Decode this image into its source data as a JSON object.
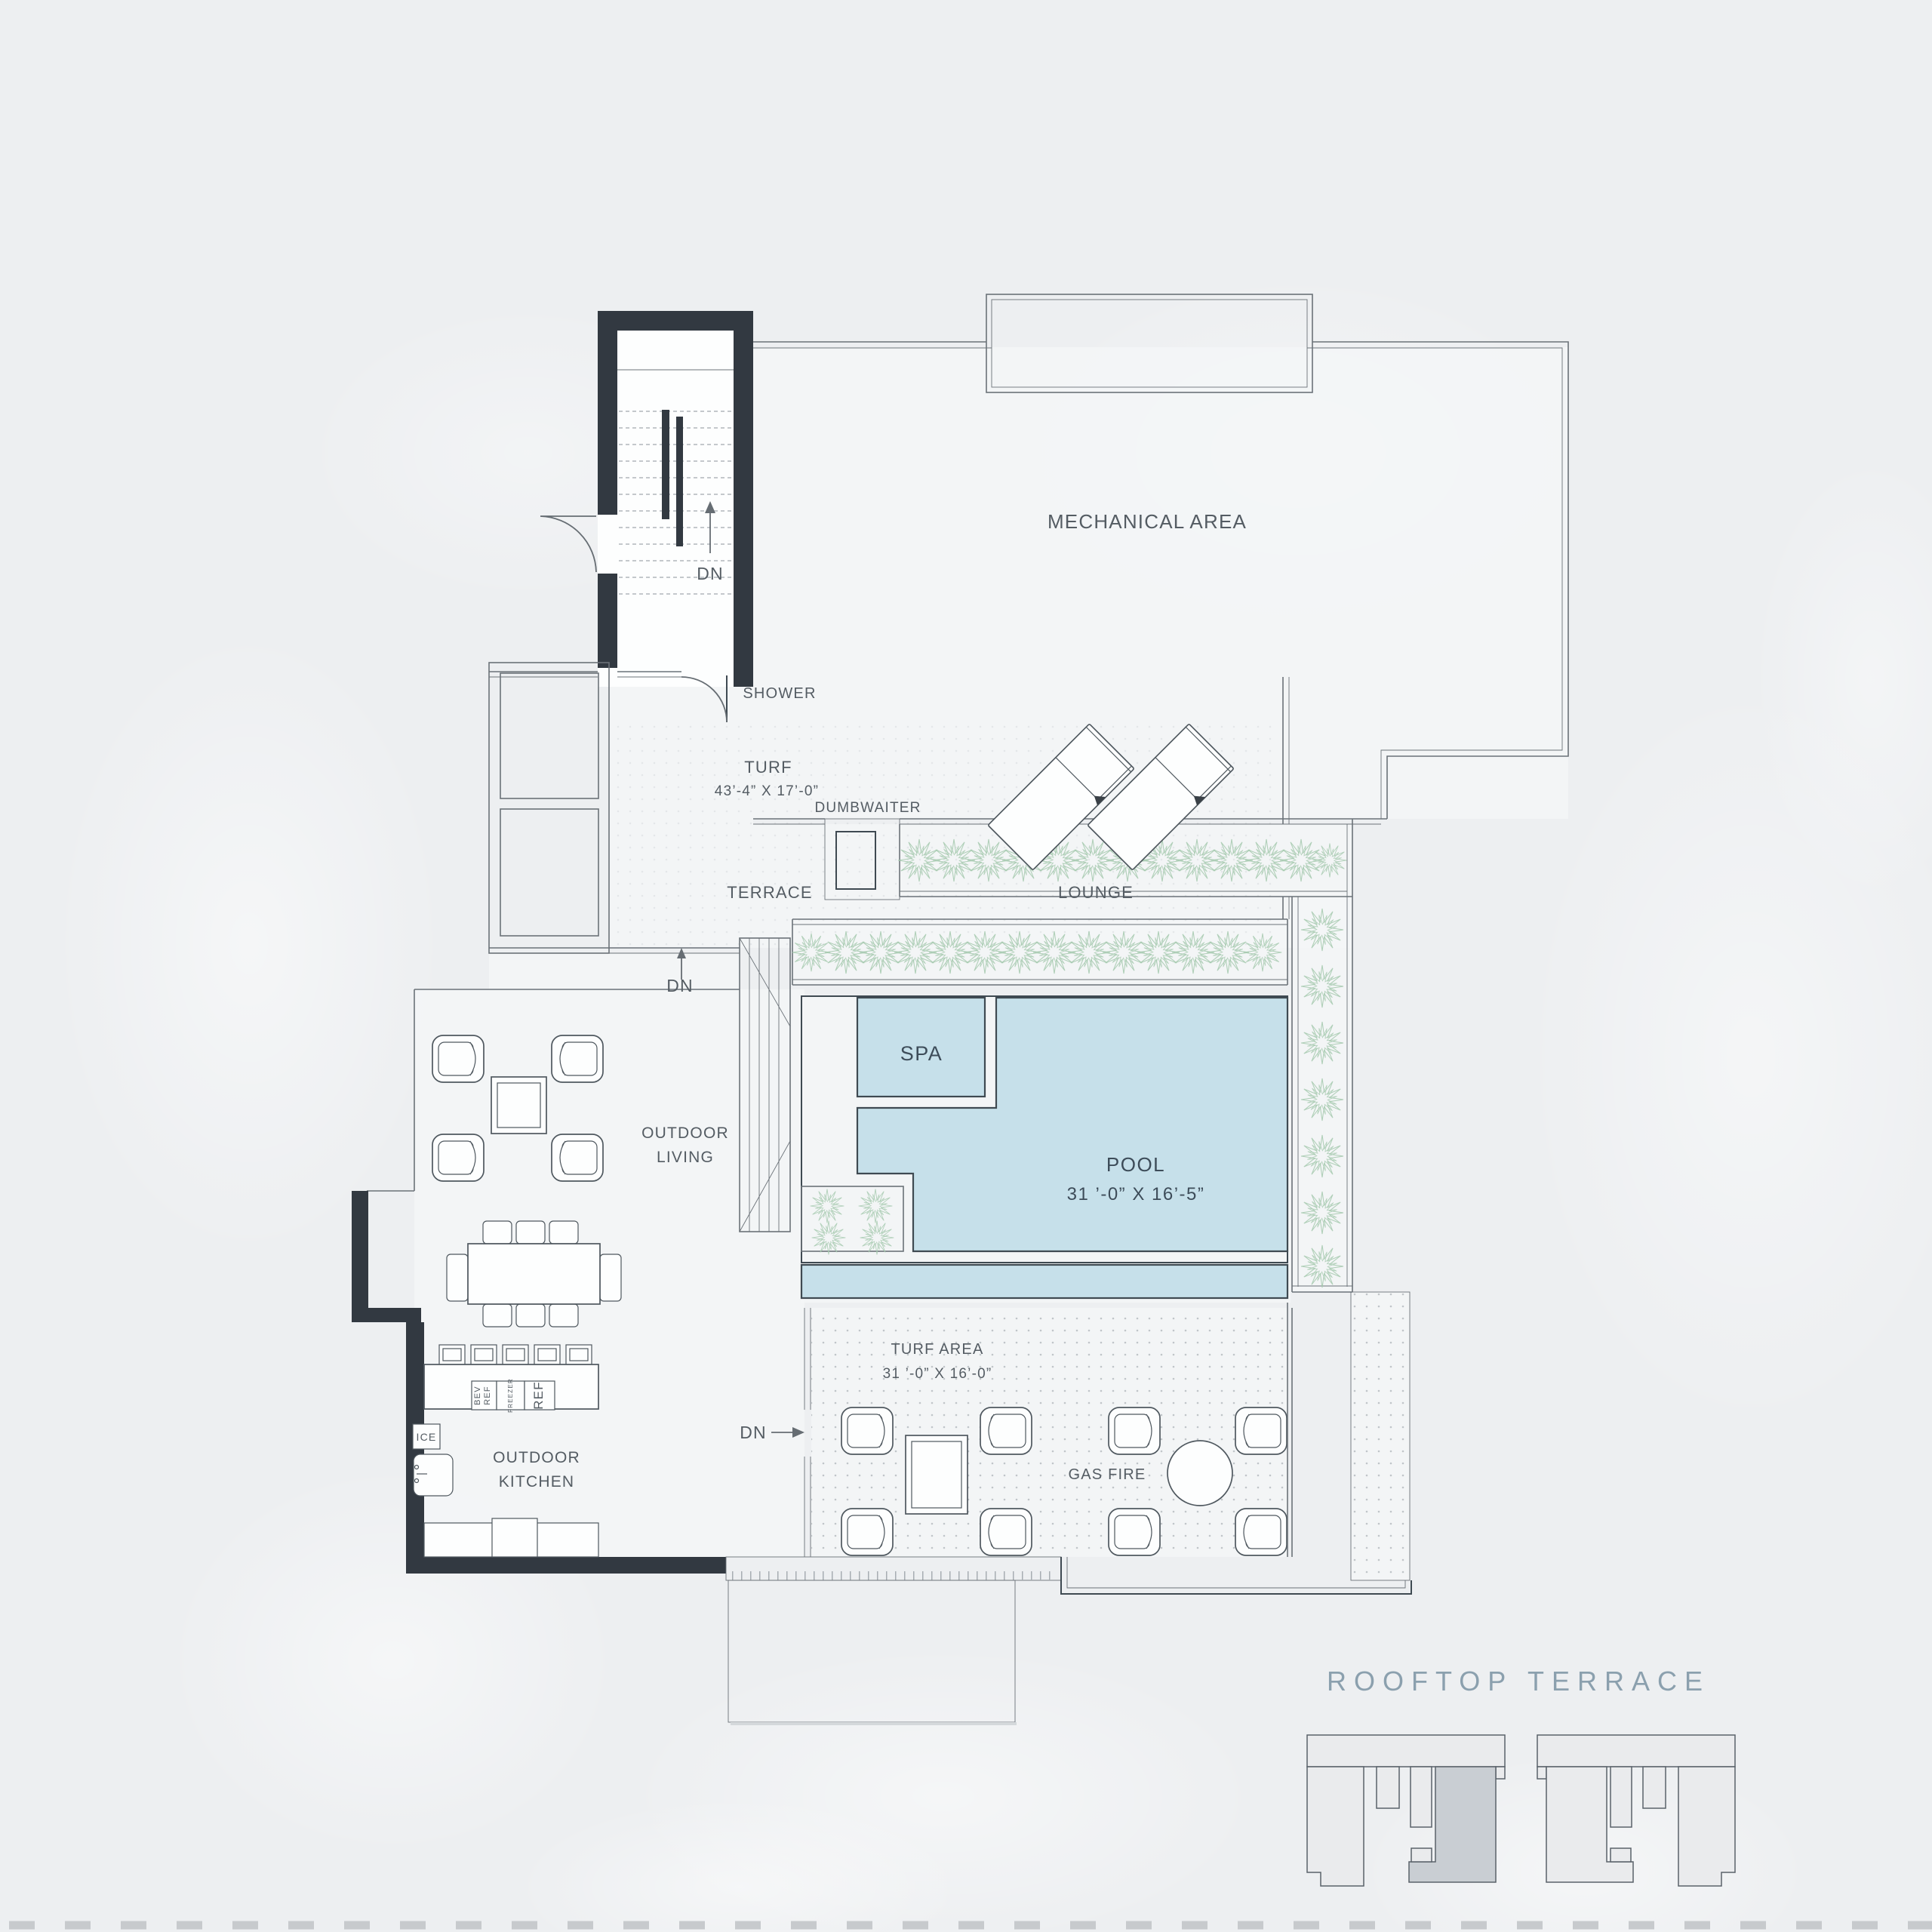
{
  "title": "ROOFTOP TERRACE",
  "colors": {
    "background": "#edeff1",
    "wall": "#323941",
    "line": "#6b7278",
    "water": "#c6e0ea",
    "water_outline": "#3f4a52",
    "plant": "#a5c9ae",
    "text": "#545c63",
    "text_dark": "#3d4c59",
    "title": "#8ba0ae",
    "keyplan_fill": "#eaebed",
    "keyplan_highlight": "#c9ced3",
    "keyplan_stroke": "#5a626a",
    "dots": "#b7bdc1",
    "dash": "#c7cacd"
  },
  "labels": {
    "mechanical": "MECHANICAL AREA",
    "dumbwaiter": "DUMBWAITER",
    "shower": "SHOWER",
    "turf": "TURF",
    "turf_dims": "43’-4” X 17’-0”",
    "terrace": "TERRACE",
    "lounge": "LOUNGE",
    "dn_stairs": "DN",
    "dn_landing": "DN",
    "dn_kitchen": "DN",
    "spa": "SPA",
    "pool": "POOL",
    "pool_dims": "31 ’-0” X 16’-5”",
    "outdoor": "OUTDOOR",
    "living": "LIVING",
    "kitchen": "KITCHEN",
    "turf_area": "TURF AREA",
    "turf_area_dims": "31 ’-0” X 16’-0”",
    "gas_fire": "GAS FIRE",
    "bev": "BEV",
    "bev_ref": "REF",
    "freezer": "FREEZER",
    "ref": "REF",
    "ice": "ICE"
  }
}
